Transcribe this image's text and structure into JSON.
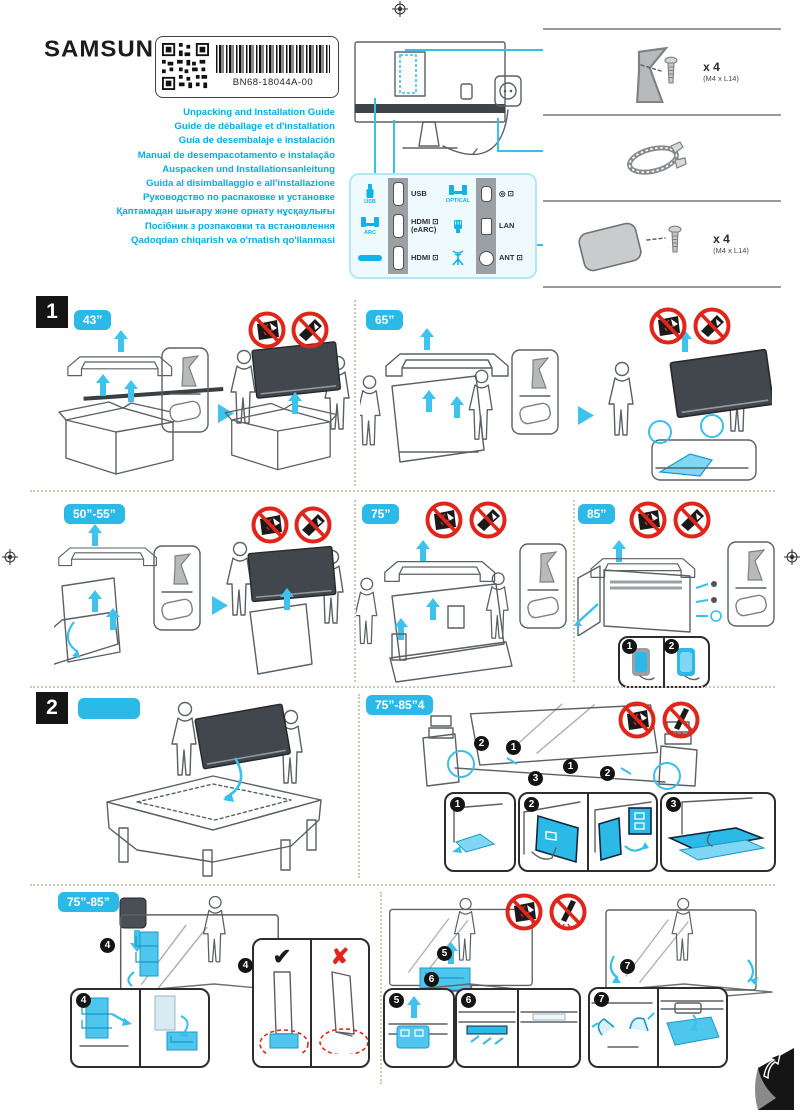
{
  "brand": "SAMSUNG",
  "label_box": {
    "part_number": "BN68-18044A-00"
  },
  "titles": [
    "Unpacking and Installation Guide",
    "Guide de déballage et d'installation",
    "Guía de desembalaje e instalación",
    "Manual de desempacotamento e instalação",
    "Auspacken und Installationsanleitung",
    "Guida al disimballaggio e all'installazione",
    "Руководство по распаковке и установке",
    "Қаптамадан шығару және орнату нұсқаулығы",
    "Посібник з розпаковки та встановлення",
    "Qadoqdan chiqarish va o'rnatish qo'llanmasi"
  ],
  "colors": {
    "accent_text": "#00aee4",
    "badge_cyan": "#2bb9e8",
    "prohibition_red": "#e0251b",
    "foam_cyan": "#4ec6ee"
  },
  "ports": {
    "usb_device_label": "USB",
    "arc_device_label": "ARC",
    "optical_device_label": "OPTICAL",
    "usb_port_label": "USB",
    "optical_out_glyphs": "◎ ⊡",
    "hdmi_earc_line1": "HDMI ⊡",
    "hdmi_earc_line2": "(eARC)",
    "lan_port_label": "LAN",
    "hdmi_port_label": "HDMI ⊡",
    "ant_port_label": "ANT ⊡"
  },
  "parts": {
    "stand_neck_qty": "x 4",
    "stand_neck_spec": "(M4 x L14)",
    "stand_base_qty": "x 4",
    "stand_base_spec": "(M4 x L14)"
  },
  "section1": {
    "number": "1",
    "size_43": "43”",
    "size_65": "65”",
    "size_50_55": "50”-55”",
    "size_75": "75”",
    "size_85": "85”"
  },
  "section2": {
    "number": "2",
    "badge_top_right": "75”-85”4",
    "badge_bottom": "75”-85”",
    "check": "✔",
    "cross": "✘",
    "steps": [
      "1",
      "2",
      "3",
      "4",
      "5",
      "6",
      "7"
    ]
  }
}
